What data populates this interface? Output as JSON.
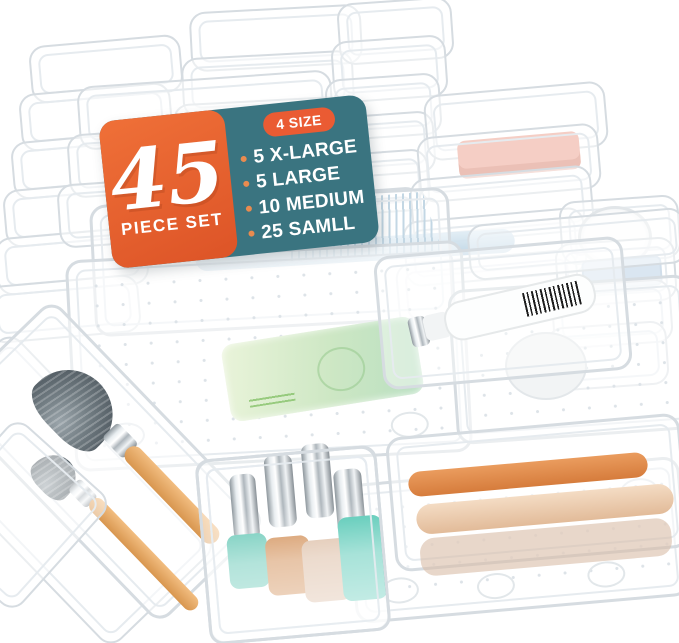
{
  "meta": {
    "description": "Product photo of a 45-piece clear plastic drawer organizer set shown with cosmetics (makeup brushes, hairbrush, nail polish bottles, soap, tube, compact)",
    "background_color": "#ffffff",
    "tray_outline_color": "#d6dce1"
  },
  "badge": {
    "number": "45",
    "number_label": "PIECE SET",
    "pill": "4 SIZE",
    "sizes": [
      "5 X-LARGE",
      "5 LARGE",
      "10 MEDIUM",
      "25 SAMLL"
    ],
    "colors": {
      "panel_orange": "#e5632f",
      "panel_teal": "#3a7480",
      "pill_orange": "#ea5b33",
      "bullet_orange": "#e98b4f",
      "text": "#ffffff"
    }
  },
  "objects": [
    {
      "name": "stacked-clear-trays-top-left"
    },
    {
      "name": "stacked-clear-trays-top-center"
    },
    {
      "name": "stacked-small-square-trays-top-right"
    },
    {
      "name": "stacked-medium-trays-right",
      "contains": "pink-case",
      "pink": "#eb9d8a"
    },
    {
      "name": "stacked-small-trays-with-compact",
      "compact": "#fdfdfd",
      "blue_case": "#b5cde2"
    },
    {
      "name": "hairbrush-blue-bristles",
      "bristles": "#a3c2d6",
      "paddle": "#cfe2ef"
    },
    {
      "name": "x-large-tray-with-green-soap",
      "soap": "#cde7c4"
    },
    {
      "name": "medium-tray-with-white-tube",
      "tube": "#fdfefe",
      "barcode": "#1d1d1d"
    },
    {
      "name": "long-tray-with-makeup-brushes",
      "handles": "#e0a35f",
      "bristles": "#5d676e"
    },
    {
      "name": "small-bin-with-nail-polish",
      "bottle_colors": [
        "#66c8b6",
        "#d08a4f",
        "#d9b79c",
        "#4fc6b2"
      ],
      "caps": "silver"
    },
    {
      "name": "medium-tray-with-cosmetic-rollers",
      "roller_colors": [
        "#e0904e",
        "#eed4ba"
      ]
    },
    {
      "name": "large-dotted-tray-bottom-right"
    }
  ]
}
